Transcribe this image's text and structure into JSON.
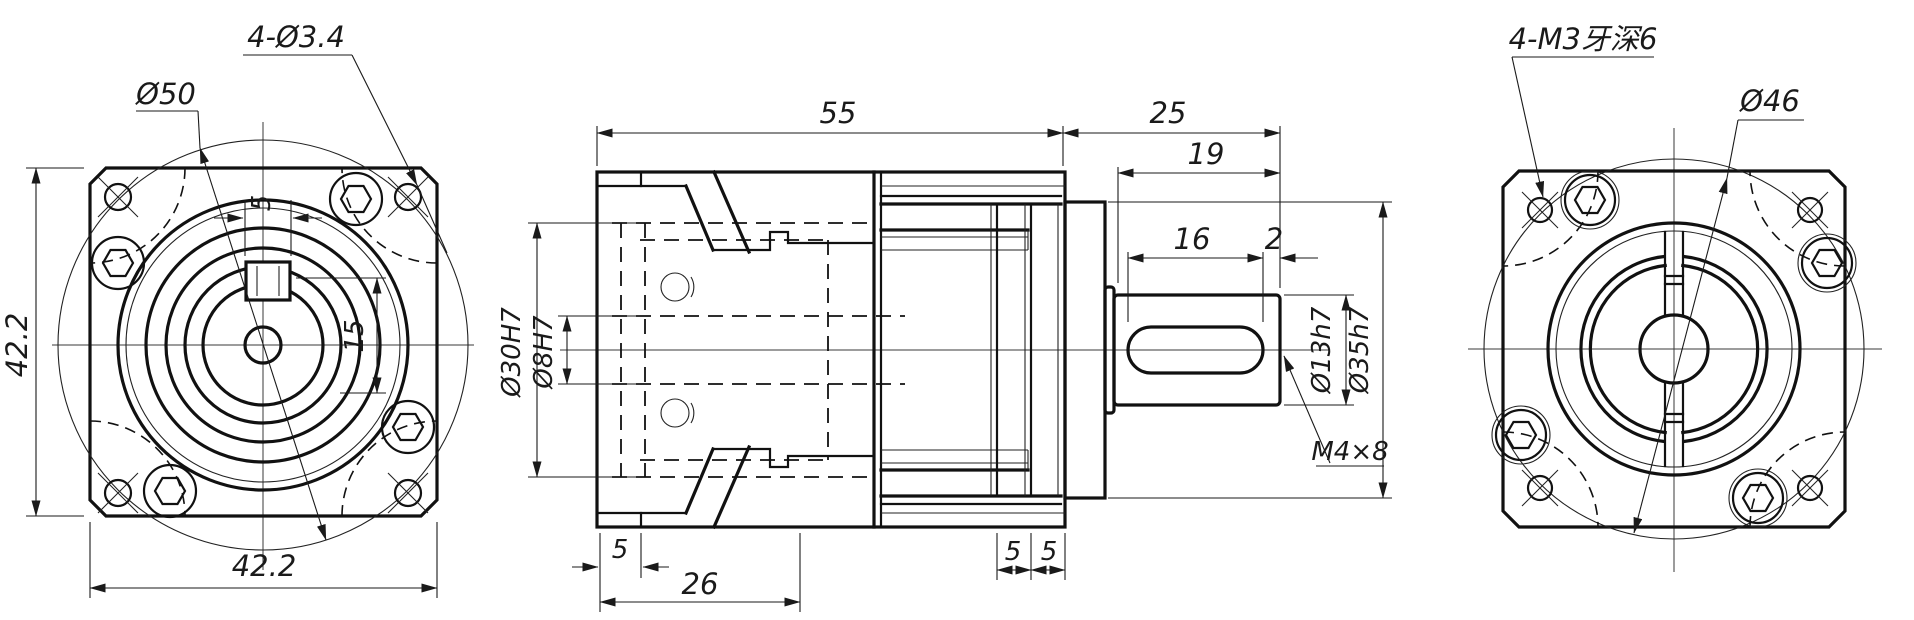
{
  "app": {
    "background": "#ffffff",
    "line_color": "#111111",
    "drawing_type": "planetary-gearbox-three-view"
  },
  "views": {
    "front": {
      "labels": {
        "corner_holes": "4-Ø3.4",
        "pilot_circle": "Ø50",
        "height": "42.2",
        "width": "42.2",
        "key_width": "5",
        "key_height": "15"
      }
    },
    "side": {
      "labels": {
        "body_length": "55",
        "output_section": "25",
        "shaft_length": "19",
        "keyway_length": "16",
        "keyway_end_gap": "2",
        "shaft_diameter": "Ø13h7",
        "pilot_diameter": "Ø35h7",
        "tapped_hole": "M4×8",
        "flange_thickness": "5",
        "front_section": "26",
        "plate_thickness_a": "5",
        "plate_thickness_b": "5",
        "gear_bore": "Ø30H7",
        "input_bore": "Ø8H7"
      }
    },
    "rear": {
      "labels": {
        "tapped_holes": "4-M3牙深6",
        "bolt_circle": "Ø46"
      }
    }
  }
}
